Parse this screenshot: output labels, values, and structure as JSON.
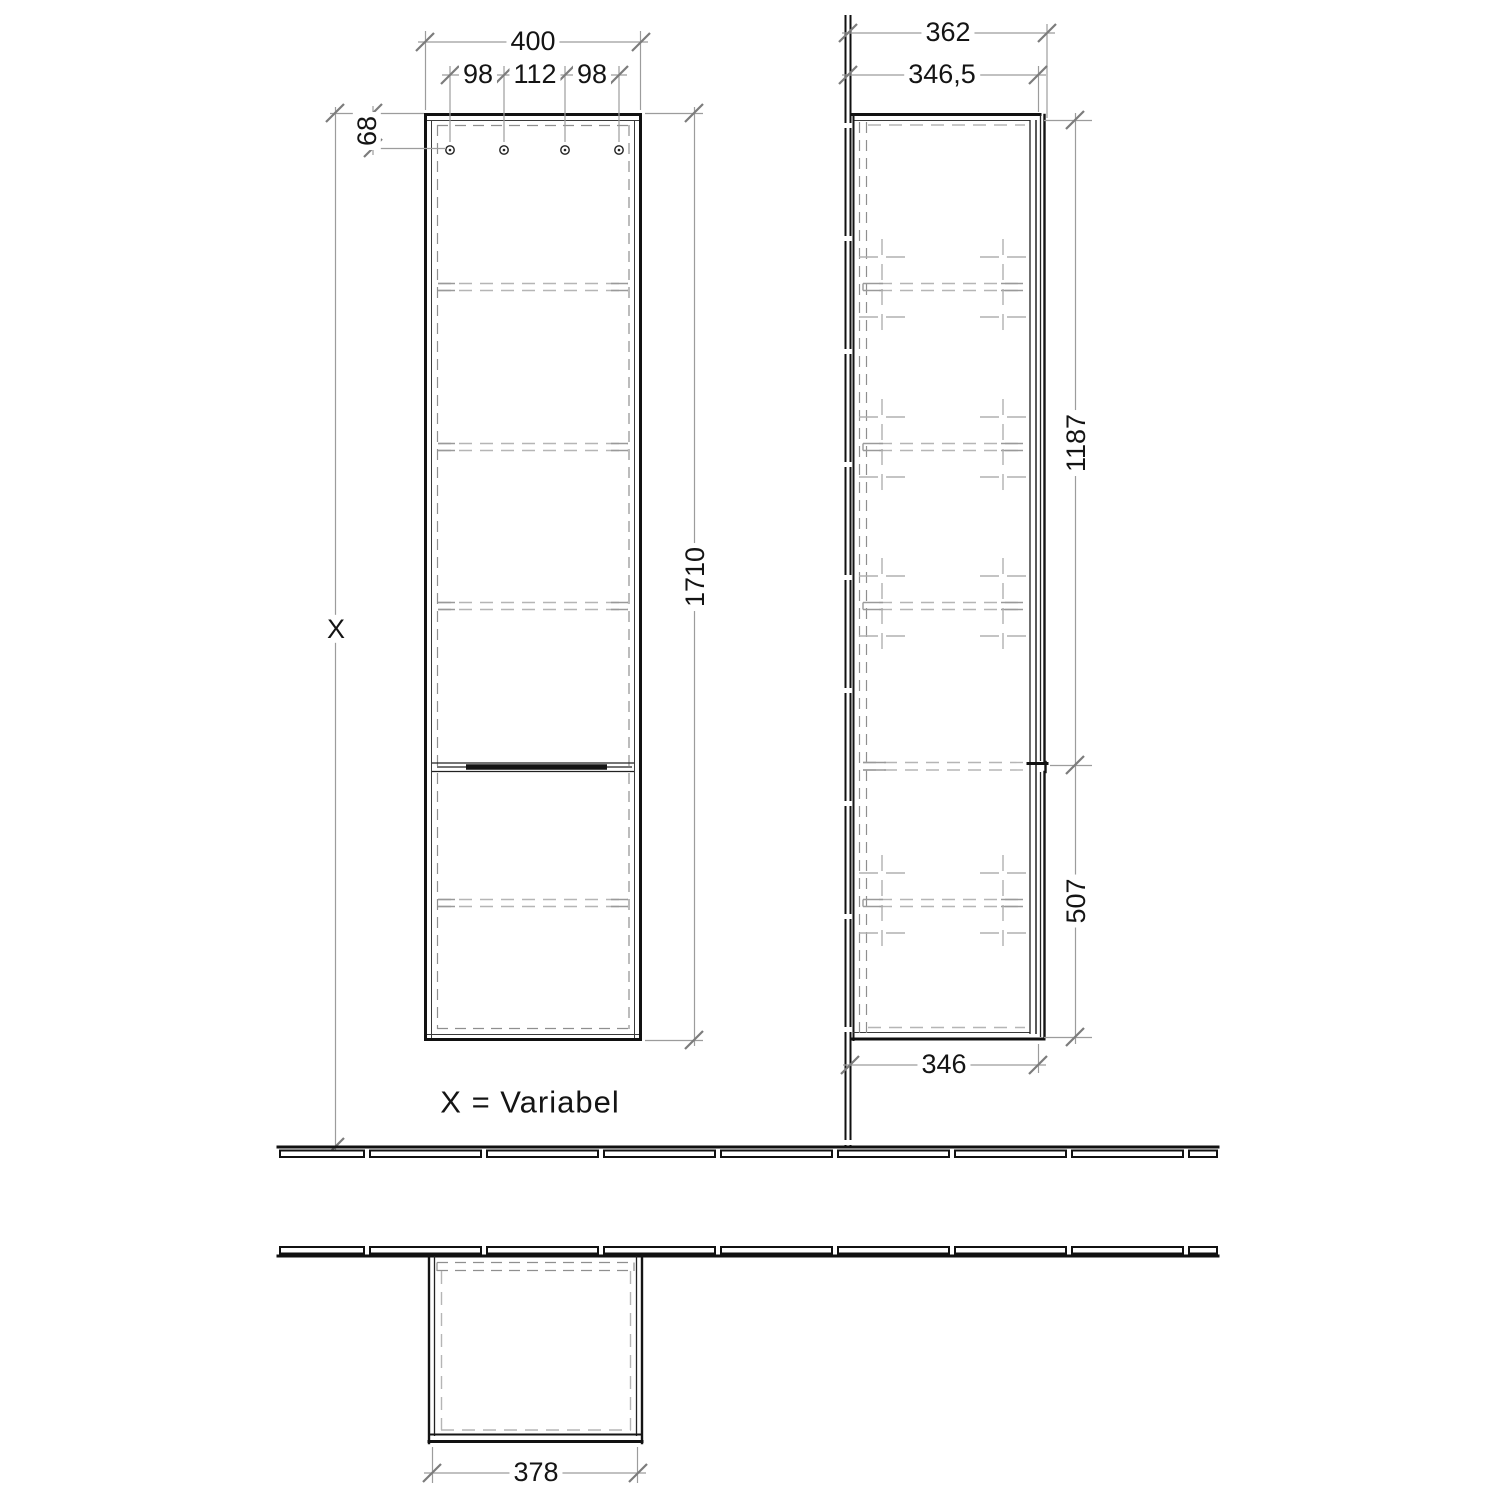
{
  "drawing": {
    "note_label": "X = Variabel",
    "front_view": {
      "dims": {
        "overall_width": "400",
        "hole_pitch_left": "98",
        "hole_pitch_center": "112",
        "hole_pitch_right": "98",
        "top_to_hanger_holes": "68",
        "cabinet_height": "1710",
        "mounting_height": "X"
      }
    },
    "side_view": {
      "dims": {
        "overall_depth": "362",
        "depth_to_body_front": "346,5",
        "upper_door_height": "1187",
        "lower_door_height": "507",
        "body_depth_bottom": "346"
      }
    },
    "top_view": {
      "dims": {
        "front_width": "378"
      }
    }
  }
}
